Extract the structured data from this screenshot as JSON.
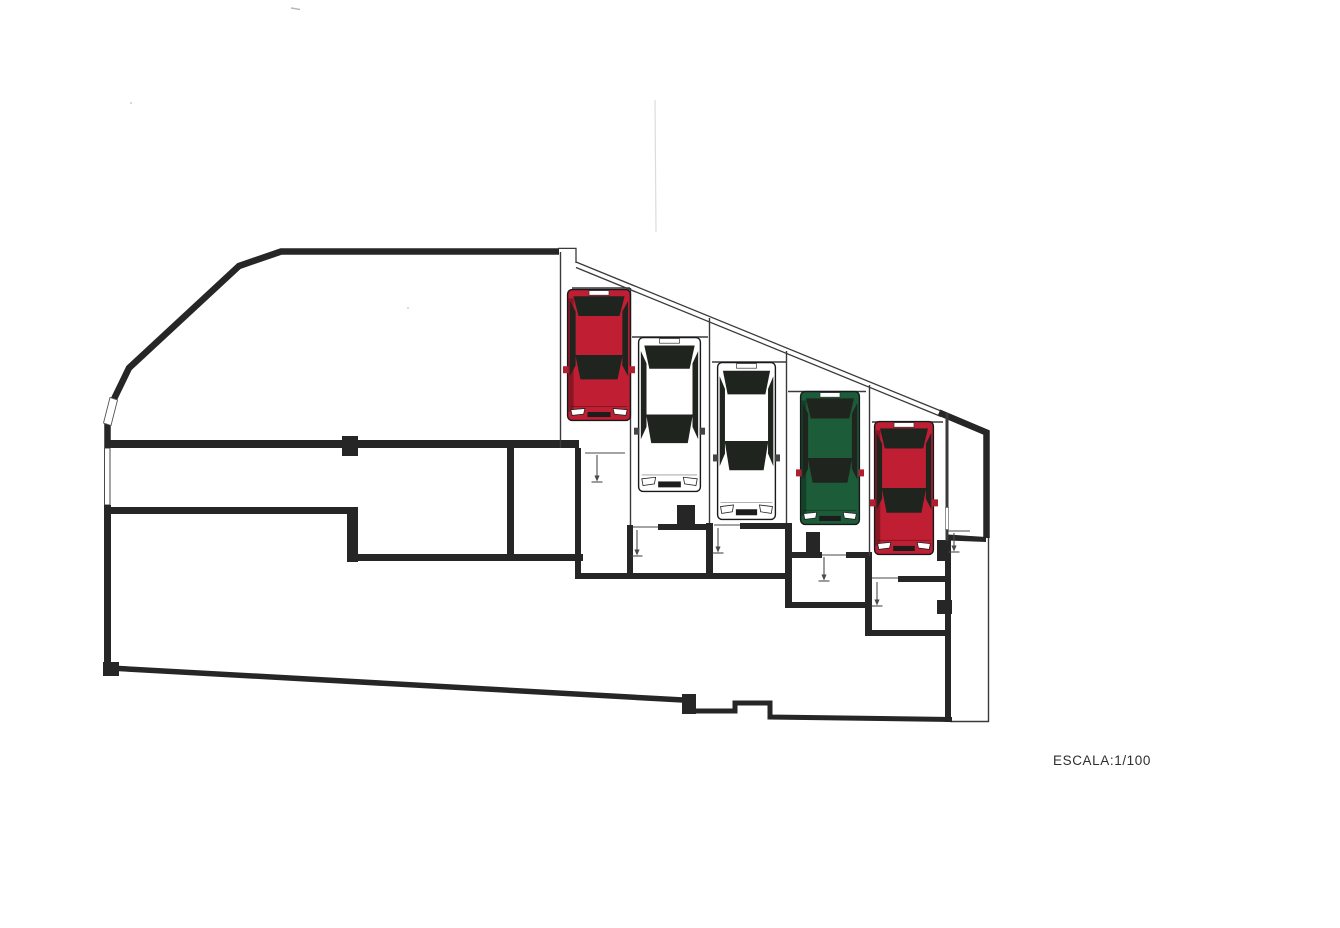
{
  "scale_text": "ESCALA:1/100",
  "colors": {
    "wall": "#262626",
    "thin_line": "#3a3a3a",
    "paper": "#ffffff",
    "glass": "#20241f",
    "red": "#c01f33",
    "green": "#1d5c38",
    "white": "#ffffff",
    "mirror_red": "#b01f30",
    "mirror_dark": "#444444",
    "marker": "#4a4a4a"
  },
  "cars": [
    {
      "id": "car-red-1",
      "color": "red",
      "x": 567,
      "y": 289,
      "w": 64,
      "h": 132
    },
    {
      "id": "car-white-1",
      "color": "white",
      "x": 638,
      "y": 337,
      "w": 63,
      "h": 155
    },
    {
      "id": "car-white-2",
      "color": "white",
      "x": 717,
      "y": 362,
      "w": 59,
      "h": 158
    },
    {
      "id": "car-green-1",
      "color": "green",
      "x": 800,
      "y": 391,
      "w": 60,
      "h": 134
    },
    {
      "id": "car-red-2",
      "color": "red",
      "x": 874,
      "y": 421,
      "w": 60,
      "h": 134
    }
  ],
  "door_markers": [
    {
      "id": "door-marker-1",
      "leaf": [
        585,
        453,
        625,
        453
      ],
      "x": 597,
      "y1": 455,
      "y2": 482
    },
    {
      "id": "door-marker-2",
      "leaf": [
        633,
        527,
        658,
        527
      ],
      "x": 637,
      "y1": 530,
      "y2": 556
    },
    {
      "id": "door-marker-3",
      "leaf": [
        714,
        525,
        740,
        525
      ],
      "x": 718,
      "y1": 528,
      "y2": 553
    },
    {
      "id": "door-marker-4",
      "leaf": [
        822,
        555,
        846,
        555
      ],
      "x": 824,
      "y1": 557,
      "y2": 581
    },
    {
      "id": "door-marker-5",
      "leaf": [
        872,
        578,
        898,
        578
      ],
      "x": 877,
      "y1": 582,
      "y2": 606
    },
    {
      "id": "door-marker-6",
      "leaf": [
        948,
        531,
        970,
        531
      ],
      "x": 954,
      "y1": 533,
      "y2": 552
    }
  ]
}
